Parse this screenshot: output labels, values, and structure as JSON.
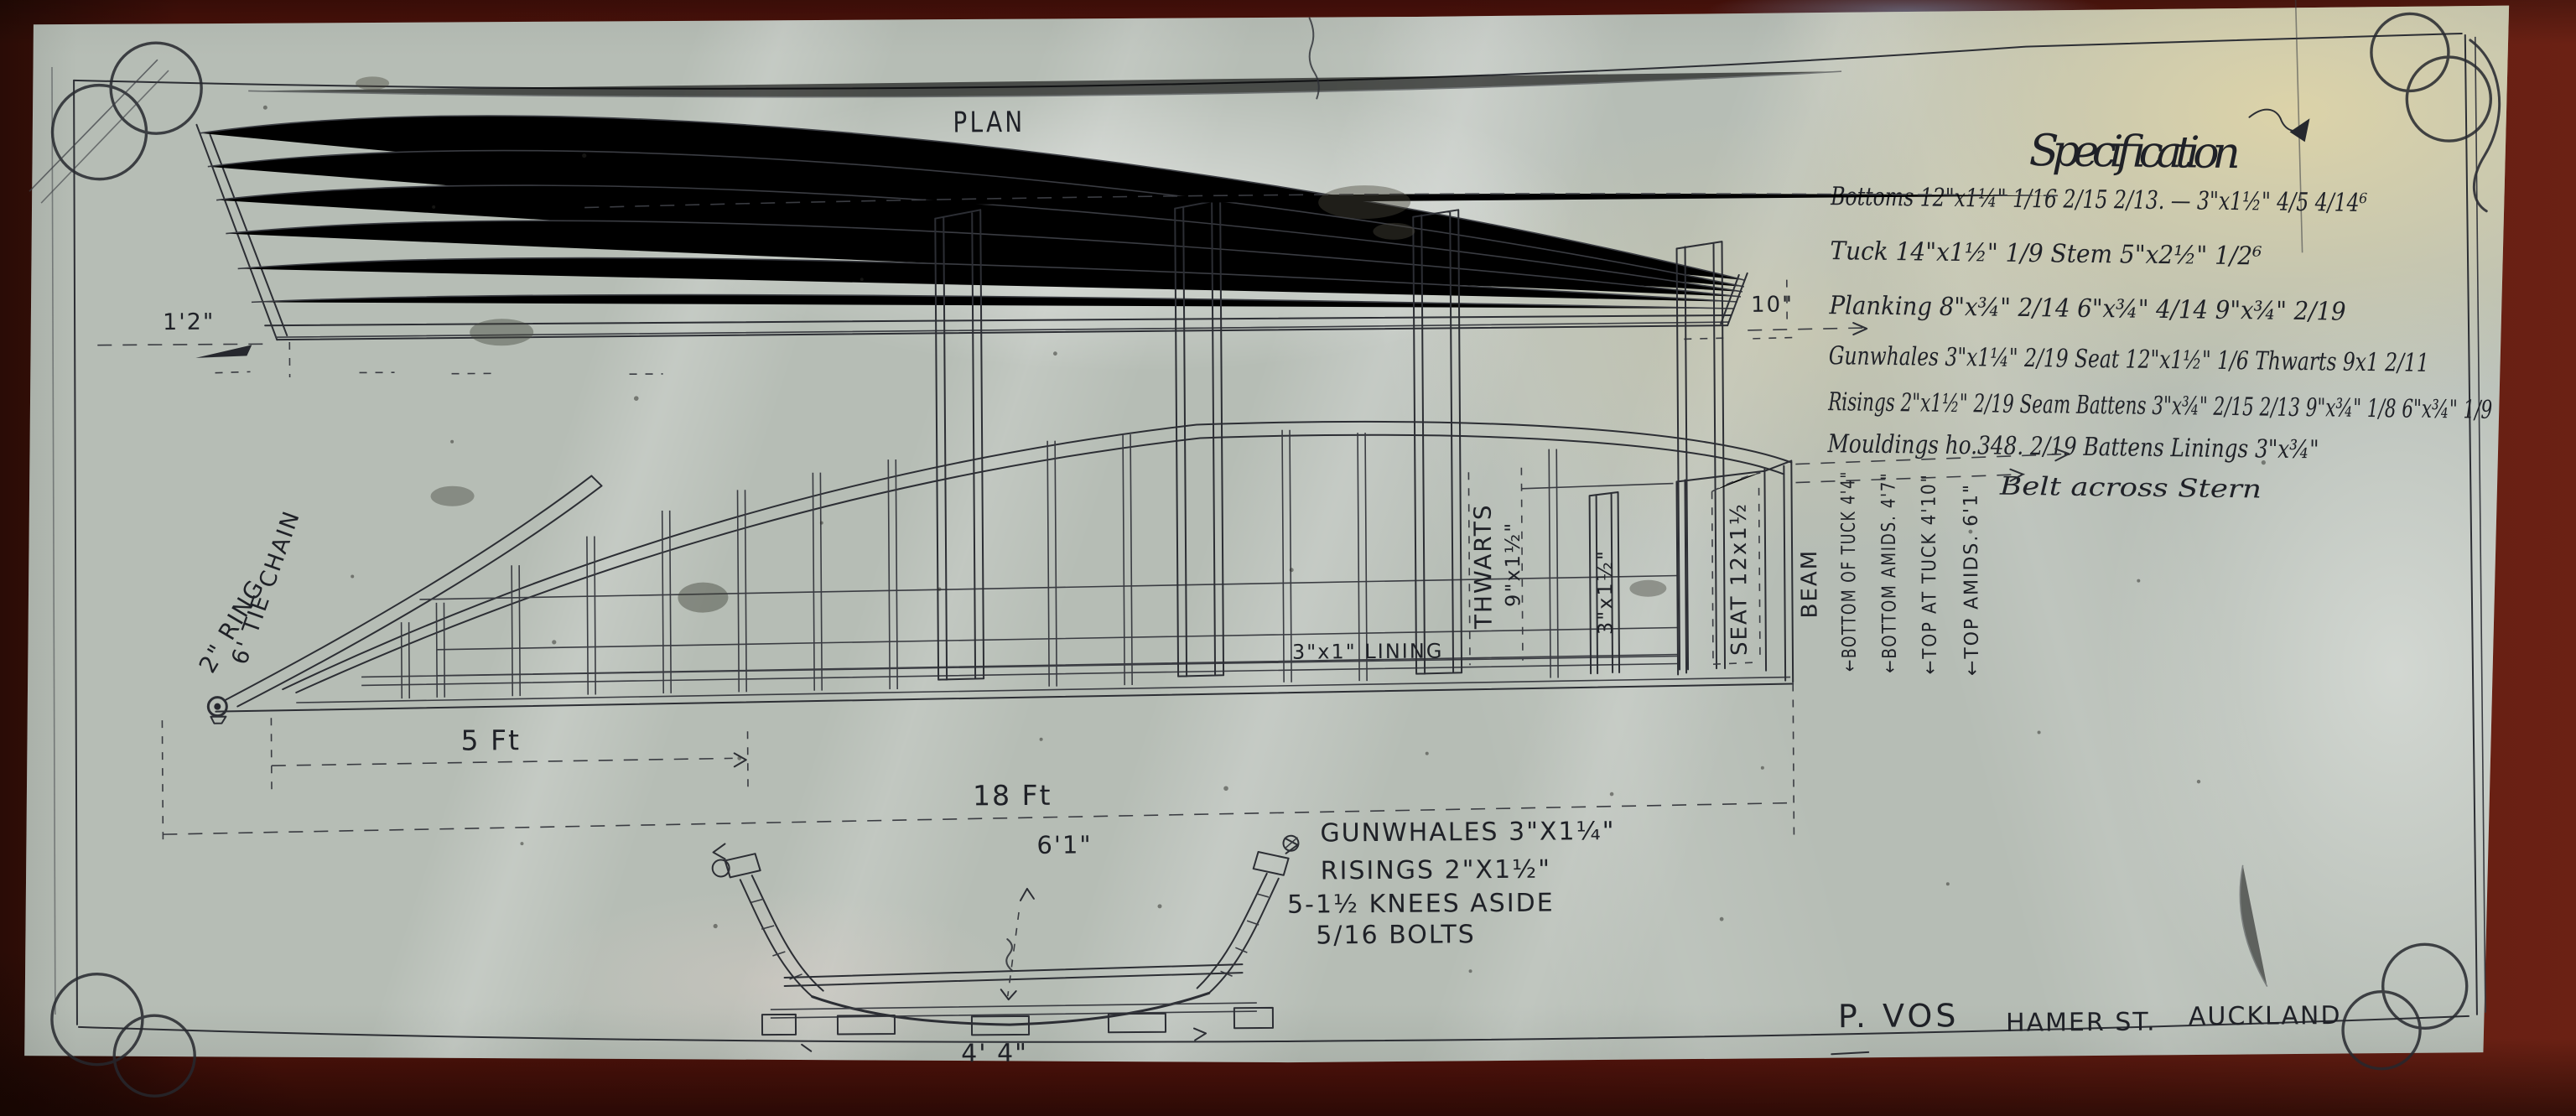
{
  "colors": {
    "wall": "#55130c",
    "paper": "#b6bdb5",
    "ink": "#2c2e34"
  },
  "title": {
    "line1": "PLAN",
    "line2": "OF",
    "line3": "BOAT  FOR  WAITOMO  CAVES"
  },
  "specification": {
    "heading": "Specification",
    "lines": [
      "Bottoms 12\"x1¼\"  1/16  2/15  2/13. —  3\"x1½\"  4/5   4/14⁶",
      "Tuck 14\"x1½\"  1/9     Stem 5\"x2½\"  1/2⁶",
      "Planking 8\"x¾\"  2/14    6\"x¾\"  4/14    9\"x¾\"  2/19",
      "Gunwhales 3\"x1¼\"  2/19    Seat 12\"x1½\"  1/6   Thwarts 9x1  2/11",
      "Risings 2\"x1½\"  2/19  Seam Battens 3\"x¾\"  2/15  2/13  9\"x¾\" 1/8  6\"x¾\" 1/9",
      "Mouldings ho.348.  2/19    Battens Linings 3\"x¾\""
    ],
    "footnote": "Belt across Stern"
  },
  "profile_view": {
    "bow_height": "1'2\"",
    "stern_height": "10\""
  },
  "elevation_view": {
    "ring": "2\" RING",
    "tie_chain": "6' TIE CHAIN",
    "thwarts_line1": "THWARTS",
    "thwarts_line2": "9\"x1½\"",
    "frame_size": "3\"x1½\"",
    "seat": "SEAT 12x1½",
    "lining": "3\"x1\" LINING",
    "beam": "BEAM",
    "bottom_of_tuck": "←BOTTOM OF TUCK 4'4\"",
    "bottom_amids": "←BOTTOM AMIDS. 4'7\"",
    "top_at_tuck": "←TOP AT TUCK 4'10\"",
    "top_amids": "←TOP AMIDS. 6'1\"",
    "dim_5ft": "5 Ft",
    "dim_18ft": "18 Ft"
  },
  "section_view": {
    "top_width": "6'1\"",
    "bottom_width": "4'  4\"",
    "notes": [
      "GUNWHALES 3\"X1¼\"",
      "RISINGS 2\"X1½\"",
      "5-1½ KNEES ASIDE",
      "5/16 BOLTS"
    ]
  },
  "footer": {
    "name": "P. VOS",
    "street": "HAMER ST.",
    "city": "AUCKLAND"
  }
}
